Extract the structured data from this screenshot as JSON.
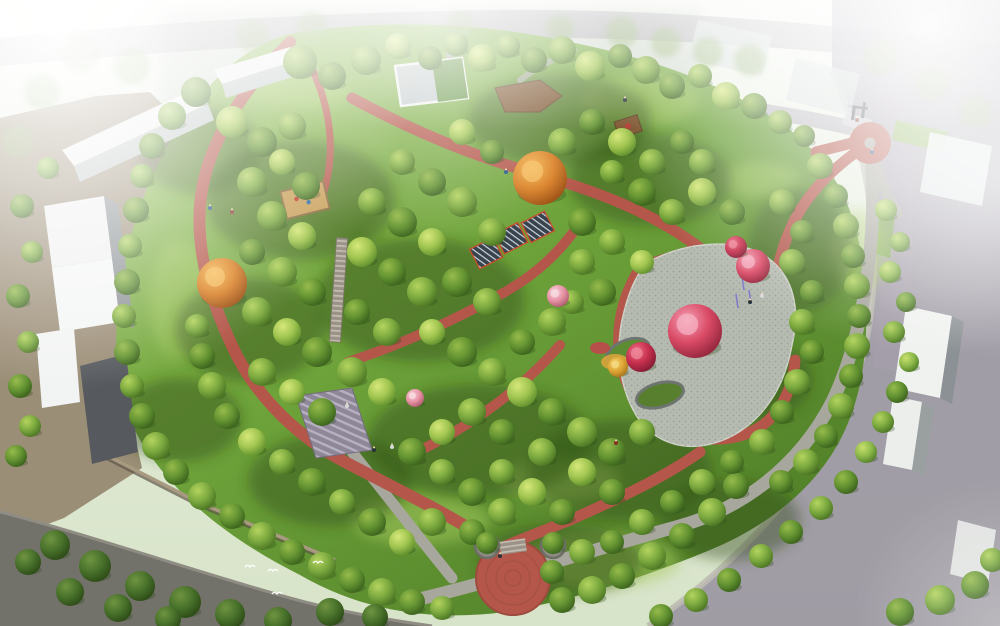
{
  "meta": {
    "title": "Park master plan aerial rendering",
    "image_type": "architectural landscape rendering, bird's-eye perspective",
    "description": "Wooded community park with winding red jogging paths, a slatted pergola pavilion, a cobbled plaza with pink flowering trees, stone stairways, a circular red south-entrance plaza, perimeter gray and purple city roads, white apartment slab buildings on the left and hazy city blocks fading to white at the top corners."
  },
  "palette": {
    "sky_haze": "#f3f6ee",
    "field_mist": "#bcc7bb",
    "grass_light": "#93c051",
    "grass_mid": "#6da23a",
    "grass_dark": "#4f7d27",
    "canopy_shadow": "#2c4a16",
    "path_red": "#b4574a",
    "path_red_dark": "#9c4b3d",
    "road_gray": "#a8a79d",
    "road_dark": "#72716a",
    "road_purple": "#948c9c",
    "sidewalk": "#bdbbb1",
    "ground_tan": "#8f7e66",
    "building_top": "#eef0ee",
    "building_face": "#c2c8c8",
    "building_side": "#8b9194",
    "building_dark": "#565a5e",
    "plaza_paving": "#b6bbb1",
    "paving_fleck": "#8f968c",
    "wall_stone": "#a89a80",
    "stair_stone": "#9a9287",
    "stair_purple": "#8e8798",
    "deck_wood": "#7d552f",
    "pergola_roof": "#39434d",
    "pergola_frame": "#c7502b",
    "sand": "#caa15b",
    "autumn_orange": "#d97e22",
    "amber": "#dfa636",
    "blossom_pink": "#da4a66",
    "blossom_light": "#e794a6",
    "blossom_red": "#c62f4d",
    "haze_white": "#ffffff"
  },
  "scene": {
    "canopy_shade": [
      [
        300,
        200,
        95,
        60
      ],
      [
        250,
        330,
        75,
        52
      ],
      [
        420,
        300,
        105,
        62
      ],
      [
        560,
        120,
        92,
        46
      ],
      [
        650,
        180,
        82,
        46
      ],
      [
        480,
        440,
        112,
        56
      ],
      [
        620,
        470,
        92,
        50
      ],
      [
        750,
        380,
        62,
        42
      ],
      [
        330,
        480,
        82,
        46
      ],
      [
        560,
        560,
        82,
        36
      ],
      [
        800,
        250,
        52,
        62
      ],
      [
        180,
        420,
        62,
        42
      ],
      [
        200,
        150,
        60,
        45
      ],
      [
        730,
        520,
        70,
        40
      ]
    ],
    "bright_lawn": [
      [
        420,
        520,
        70,
        25
      ],
      [
        560,
        480,
        60,
        22
      ],
      [
        760,
        180,
        40,
        18
      ],
      [
        300,
        90,
        50,
        20
      ],
      [
        860,
        250,
        28,
        40
      ],
      [
        640,
        100,
        60,
        25
      ],
      [
        600,
        560,
        80,
        28
      ],
      [
        180,
        300,
        30,
        60
      ]
    ],
    "bg_trees": [
      [
        80,
        52,
        20
      ],
      [
        132,
        66,
        18
      ],
      [
        252,
        36,
        16
      ],
      [
        312,
        26,
        15
      ],
      [
        622,
        32,
        16
      ],
      [
        666,
        42,
        15
      ],
      [
        708,
        52,
        15
      ],
      [
        750,
        60,
        16
      ],
      [
        882,
        56,
        18
      ],
      [
        932,
        82,
        17
      ],
      [
        976,
        112,
        16
      ],
      [
        42,
        92,
        18
      ],
      [
        18,
        142,
        16
      ],
      [
        560,
        28,
        14
      ],
      [
        460,
        24,
        13
      ]
    ],
    "trees": [
      [
        300,
        62,
        17,
        "b"
      ],
      [
        332,
        76,
        14,
        "c"
      ],
      [
        366,
        60,
        15,
        "b"
      ],
      [
        398,
        46,
        13,
        "a"
      ],
      [
        430,
        58,
        12,
        "c"
      ],
      [
        456,
        44,
        12,
        "b"
      ],
      [
        482,
        58,
        14,
        "a"
      ],
      [
        508,
        46,
        12,
        "b"
      ],
      [
        534,
        60,
        13,
        "c"
      ],
      [
        562,
        50,
        14,
        "b"
      ],
      [
        590,
        66,
        15,
        "a"
      ],
      [
        620,
        56,
        12,
        "c"
      ],
      [
        646,
        70,
        14,
        "b"
      ],
      [
        672,
        86,
        13,
        "c"
      ],
      [
        700,
        76,
        12,
        "b"
      ],
      [
        726,
        96,
        14,
        "a"
      ],
      [
        754,
        106,
        13,
        "c"
      ],
      [
        780,
        122,
        12,
        "b"
      ],
      [
        804,
        136,
        11,
        "c"
      ],
      [
        196,
        92,
        15,
        "c"
      ],
      [
        172,
        116,
        14,
        "b"
      ],
      [
        152,
        146,
        13,
        "c"
      ],
      [
        142,
        176,
        12,
        "b"
      ],
      [
        136,
        210,
        13,
        "c"
      ],
      [
        130,
        246,
        12,
        "b"
      ],
      [
        127,
        282,
        13,
        "c"
      ],
      [
        124,
        316,
        12,
        "b"
      ],
      [
        127,
        352,
        13,
        "c"
      ],
      [
        132,
        386,
        12,
        "b"
      ],
      [
        142,
        416,
        13,
        "c"
      ],
      [
        156,
        446,
        14,
        "b"
      ],
      [
        176,
        472,
        13,
        "c"
      ],
      [
        202,
        496,
        14,
        "b"
      ],
      [
        232,
        516,
        13,
        "c"
      ],
      [
        262,
        536,
        14,
        "b"
      ],
      [
        292,
        552,
        13,
        "c"
      ],
      [
        322,
        566,
        14,
        "b"
      ],
      [
        352,
        580,
        13,
        "c"
      ],
      [
        382,
        592,
        14,
        "b"
      ],
      [
        412,
        602,
        13,
        "c"
      ],
      [
        442,
        608,
        12,
        "b"
      ],
      [
        562,
        600,
        13,
        "c"
      ],
      [
        592,
        590,
        14,
        "b"
      ],
      [
        622,
        576,
        13,
        "c"
      ],
      [
        652,
        556,
        14,
        "b"
      ],
      [
        682,
        536,
        13,
        "c"
      ],
      [
        712,
        512,
        14,
        "b"
      ],
      [
        736,
        486,
        13,
        "c"
      ],
      [
        820,
        166,
        13,
        "b"
      ],
      [
        836,
        196,
        12,
        "c"
      ],
      [
        846,
        226,
        13,
        "b"
      ],
      [
        853,
        256,
        12,
        "c"
      ],
      [
        857,
        286,
        13,
        "b"
      ],
      [
        859,
        316,
        12,
        "c"
      ],
      [
        857,
        346,
        13,
        "b"
      ],
      [
        851,
        376,
        12,
        "c"
      ],
      [
        841,
        406,
        13,
        "b"
      ],
      [
        826,
        436,
        12,
        "c"
      ],
      [
        806,
        462,
        13,
        "b"
      ],
      [
        781,
        482,
        12,
        "c"
      ],
      [
        886,
        210,
        11,
        "e"
      ],
      [
        900,
        242,
        10,
        "b"
      ],
      [
        890,
        272,
        11,
        "e"
      ],
      [
        906,
        302,
        10,
        "c"
      ],
      [
        894,
        332,
        11,
        "b"
      ],
      [
        909,
        362,
        10,
        "e"
      ],
      [
        897,
        392,
        11,
        "c"
      ],
      [
        883,
        422,
        11,
        "b"
      ],
      [
        866,
        452,
        11,
        "e"
      ],
      [
        846,
        482,
        12,
        "c"
      ],
      [
        821,
        508,
        12,
        "b"
      ],
      [
        791,
        532,
        12,
        "c"
      ],
      [
        761,
        556,
        12,
        "b"
      ],
      [
        729,
        580,
        12,
        "c"
      ],
      [
        696,
        600,
        12,
        "b"
      ],
      [
        661,
        616,
        12,
        "c"
      ],
      [
        232,
        122,
        16,
        "a"
      ],
      [
        262,
        142,
        15,
        "c"
      ],
      [
        292,
        126,
        14,
        "b"
      ],
      [
        252,
        182,
        15,
        "b"
      ],
      [
        282,
        162,
        13,
        "a"
      ],
      [
        306,
        186,
        14,
        "c"
      ],
      [
        272,
        216,
        15,
        "b"
      ],
      [
        302,
        236,
        14,
        "a"
      ],
      [
        252,
        252,
        13,
        "c"
      ],
      [
        282,
        272,
        15,
        "b"
      ],
      [
        312,
        292,
        14,
        "c"
      ],
      [
        257,
        312,
        15,
        "b"
      ],
      [
        287,
        332,
        14,
        "a"
      ],
      [
        317,
        352,
        15,
        "c"
      ],
      [
        262,
        372,
        14,
        "b"
      ],
      [
        292,
        392,
        13,
        "a"
      ],
      [
        322,
        412,
        14,
        "c"
      ],
      [
        352,
        372,
        15,
        "b"
      ],
      [
        382,
        392,
        14,
        "a"
      ],
      [
        357,
        312,
        13,
        "c"
      ],
      [
        387,
        332,
        14,
        "b"
      ],
      [
        362,
        252,
        15,
        "a"
      ],
      [
        392,
        272,
        14,
        "c"
      ],
      [
        422,
        292,
        15,
        "b"
      ],
      [
        372,
        202,
        14,
        "b"
      ],
      [
        402,
        222,
        15,
        "c"
      ],
      [
        432,
        242,
        14,
        "a"
      ],
      [
        402,
        162,
        13,
        "b"
      ],
      [
        432,
        182,
        14,
        "c"
      ],
      [
        462,
        202,
        15,
        "b"
      ],
      [
        462,
        132,
        13,
        "a"
      ],
      [
        492,
        152,
        12,
        "c"
      ],
      [
        492,
        232,
        14,
        "b"
      ],
      [
        457,
        282,
        15,
        "c"
      ],
      [
        487,
        302,
        14,
        "b"
      ],
      [
        432,
        332,
        13,
        "a"
      ],
      [
        462,
        352,
        15,
        "c"
      ],
      [
        492,
        372,
        14,
        "b"
      ],
      [
        522,
        342,
        13,
        "c"
      ],
      [
        552,
        322,
        14,
        "b"
      ],
      [
        522,
        392,
        15,
        "a"
      ],
      [
        552,
        412,
        14,
        "c"
      ],
      [
        582,
        432,
        15,
        "b"
      ],
      [
        612,
        452,
        14,
        "c"
      ],
      [
        642,
        432,
        13,
        "b"
      ],
      [
        582,
        472,
        14,
        "a"
      ],
      [
        612,
        492,
        13,
        "c"
      ],
      [
        542,
        452,
        14,
        "b"
      ],
      [
        502,
        432,
        13,
        "c"
      ],
      [
        472,
        412,
        14,
        "b"
      ],
      [
        442,
        432,
        13,
        "a"
      ],
      [
        412,
        452,
        14,
        "c"
      ],
      [
        442,
        472,
        13,
        "b"
      ],
      [
        472,
        492,
        14,
        "c"
      ],
      [
        502,
        472,
        13,
        "b"
      ],
      [
        532,
        492,
        14,
        "a"
      ],
      [
        562,
        512,
        13,
        "c"
      ],
      [
        502,
        512,
        14,
        "b"
      ],
      [
        472,
        532,
        13,
        "c"
      ],
      [
        432,
        522,
        14,
        "b"
      ],
      [
        402,
        542,
        13,
        "a"
      ],
      [
        372,
        522,
        14,
        "c"
      ],
      [
        342,
        502,
        13,
        "b"
      ],
      [
        312,
        482,
        14,
        "c"
      ],
      [
        282,
        462,
        13,
        "b"
      ],
      [
        252,
        442,
        14,
        "a"
      ],
      [
        227,
        416,
        13,
        "c"
      ],
      [
        212,
        386,
        14,
        "b"
      ],
      [
        202,
        356,
        13,
        "c"
      ],
      [
        197,
        326,
        12,
        "b"
      ],
      [
        562,
        142,
        14,
        "b"
      ],
      [
        592,
        122,
        13,
        "c"
      ],
      [
        622,
        142,
        14,
        "a"
      ],
      [
        652,
        162,
        13,
        "b"
      ],
      [
        682,
        142,
        12,
        "c"
      ],
      [
        702,
        162,
        13,
        "b"
      ],
      [
        642,
        192,
        14,
        "c"
      ],
      [
        672,
        212,
        13,
        "b"
      ],
      [
        702,
        192,
        14,
        "a"
      ],
      [
        732,
        212,
        13,
        "c"
      ],
      [
        612,
        172,
        12,
        "b"
      ],
      [
        582,
        222,
        14,
        "c"
      ],
      [
        612,
        242,
        13,
        "b"
      ],
      [
        642,
        262,
        12,
        "a"
      ],
      [
        582,
        262,
        13,
        "b"
      ],
      [
        602,
        292,
        14,
        "c"
      ],
      [
        572,
        302,
        12,
        "b"
      ],
      [
        782,
        202,
        13,
        "b"
      ],
      [
        802,
        232,
        12,
        "c"
      ],
      [
        792,
        262,
        13,
        "b"
      ],
      [
        812,
        292,
        12,
        "c"
      ],
      [
        802,
        322,
        13,
        "b"
      ],
      [
        812,
        352,
        12,
        "c"
      ],
      [
        797,
        382,
        13,
        "b"
      ],
      [
        782,
        412,
        12,
        "c"
      ],
      [
        762,
        442,
        13,
        "b"
      ],
      [
        732,
        462,
        12,
        "c"
      ],
      [
        702,
        482,
        13,
        "b"
      ],
      [
        672,
        502,
        12,
        "c"
      ],
      [
        642,
        522,
        13,
        "b"
      ],
      [
        612,
        542,
        12,
        "c"
      ],
      [
        582,
        552,
        13,
        "b"
      ],
      [
        552,
        572,
        12,
        "c"
      ],
      [
        22,
        206,
        12,
        "c"
      ],
      [
        32,
        252,
        11,
        "b"
      ],
      [
        18,
        296,
        12,
        "c"
      ],
      [
        28,
        342,
        11,
        "b"
      ],
      [
        20,
        386,
        12,
        "c"
      ],
      [
        30,
        426,
        11,
        "b"
      ],
      [
        16,
        456,
        11,
        "c"
      ],
      [
        48,
        168,
        11,
        "b"
      ],
      [
        55,
        545,
        15,
        "d"
      ],
      [
        95,
        566,
        16,
        "d"
      ],
      [
        140,
        586,
        15,
        "d"
      ],
      [
        185,
        602,
        16,
        "d"
      ],
      [
        230,
        614,
        15,
        "d"
      ],
      [
        278,
        621,
        14,
        "d"
      ],
      [
        70,
        592,
        14,
        "d"
      ],
      [
        118,
        608,
        14,
        "d"
      ],
      [
        28,
        562,
        13,
        "d"
      ],
      [
        168,
        619,
        13,
        "d"
      ],
      [
        330,
        612,
        14,
        "d"
      ],
      [
        375,
        617,
        13,
        "d"
      ],
      [
        900,
        612,
        14,
        "c"
      ],
      [
        940,
        600,
        15,
        "b"
      ],
      [
        975,
        585,
        14,
        "c"
      ],
      [
        992,
        560,
        12,
        "b"
      ],
      [
        487,
        543,
        11,
        "c"
      ],
      [
        553,
        543,
        11,
        "c"
      ],
      [
        222,
        283,
        25,
        "o"
      ],
      [
        540,
        178,
        27,
        "o"
      ],
      [
        618,
        367,
        10,
        "y"
      ],
      [
        695,
        331,
        27,
        "p"
      ],
      [
        753,
        266,
        17,
        "p"
      ],
      [
        736,
        247,
        11,
        "r"
      ],
      [
        641,
        357,
        15,
        "r"
      ],
      [
        558,
        296,
        11,
        "q"
      ],
      [
        415,
        398,
        9,
        "q"
      ]
    ],
    "figures": [
      [
        625,
        100
      ],
      [
        857,
        120
      ],
      [
        872,
        152
      ],
      [
        762,
        296
      ],
      [
        750,
        302
      ],
      [
        232,
        212
      ],
      [
        210,
        208
      ],
      [
        392,
        447
      ],
      [
        374,
        450
      ],
      [
        616,
        443
      ],
      [
        506,
        172
      ],
      [
        347,
        406
      ],
      [
        500,
        556
      ]
    ],
    "birds": [
      [
        250,
        567
      ],
      [
        273,
        571
      ],
      [
        318,
        563
      ],
      [
        277,
        594
      ]
    ]
  }
}
